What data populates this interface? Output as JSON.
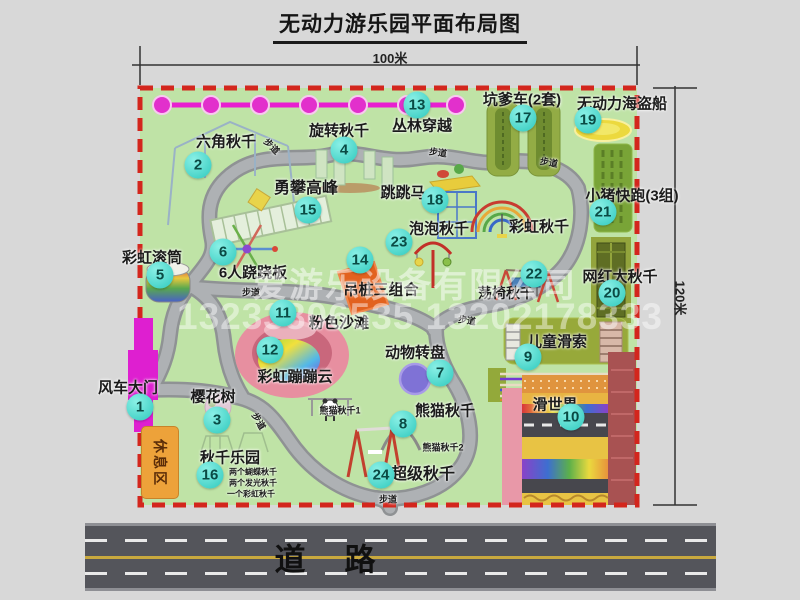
{
  "title": "无动力游乐园平面布局图",
  "dimensions": {
    "top": "100米",
    "right": "120米"
  },
  "road": {
    "label": "道　路"
  },
  "watermark": {
    "company": "爱游乐设备有限公司",
    "phone": "13233806535 13202178333"
  },
  "rest_area_label": "休息区",
  "colors": {
    "park_green": "#bfe3a6",
    "border_red": "#d3261d",
    "marker_cyan": "#2fc9bd",
    "gate_magenta": "#de1fd0",
    "road_gray": "#54555b",
    "path_gray": "#aeb1b4"
  },
  "markers": [
    {
      "n": "1",
      "x": 140,
      "y": 407
    },
    {
      "n": "2",
      "x": 198,
      "y": 165
    },
    {
      "n": "3",
      "x": 217,
      "y": 420
    },
    {
      "n": "4",
      "x": 344,
      "y": 150
    },
    {
      "n": "5",
      "x": 160,
      "y": 275
    },
    {
      "n": "6",
      "x": 223,
      "y": 252
    },
    {
      "n": "7",
      "x": 440,
      "y": 373
    },
    {
      "n": "8",
      "x": 403,
      "y": 424
    },
    {
      "n": "9",
      "x": 528,
      "y": 357
    },
    {
      "n": "10",
      "x": 571,
      "y": 417
    },
    {
      "n": "11",
      "x": 283,
      "y": 313
    },
    {
      "n": "12",
      "x": 270,
      "y": 350
    },
    {
      "n": "13",
      "x": 417,
      "y": 105
    },
    {
      "n": "14",
      "x": 360,
      "y": 260
    },
    {
      "n": "15",
      "x": 308,
      "y": 210
    },
    {
      "n": "16",
      "x": 210,
      "y": 475
    },
    {
      "n": "17",
      "x": 523,
      "y": 118
    },
    {
      "n": "18",
      "x": 435,
      "y": 200
    },
    {
      "n": "19",
      "x": 588,
      "y": 120
    },
    {
      "n": "20",
      "x": 612,
      "y": 293
    },
    {
      "n": "21",
      "x": 603,
      "y": 212
    },
    {
      "n": "22",
      "x": 534,
      "y": 274
    },
    {
      "n": "23",
      "x": 399,
      "y": 242
    },
    {
      "n": "24",
      "x": 381,
      "y": 475
    }
  ],
  "labels": [
    {
      "t": "六角秋千",
      "x": 226,
      "y": 141,
      "s": 15
    },
    {
      "t": "旋转秋千",
      "x": 339,
      "y": 130,
      "s": 15
    },
    {
      "t": "丛林穿越",
      "x": 422,
      "y": 125,
      "s": 15
    },
    {
      "t": "坑爹车(2套)",
      "x": 522,
      "y": 99,
      "s": 15
    },
    {
      "t": "无动力海盗船",
      "x": 622,
      "y": 103,
      "s": 15
    },
    {
      "t": "小猪快跑(3组)",
      "x": 632,
      "y": 195,
      "s": 15
    },
    {
      "t": "勇攀高峰",
      "x": 306,
      "y": 186,
      "s": 16
    },
    {
      "t": "跳跳马",
      "x": 403,
      "y": 192,
      "s": 15
    },
    {
      "t": "泡泡秋千",
      "x": 439,
      "y": 228,
      "s": 15
    },
    {
      "t": "彩虹秋千",
      "x": 539,
      "y": 226,
      "s": 15
    },
    {
      "t": "网红大秋千",
      "x": 620,
      "y": 276,
      "s": 15
    },
    {
      "t": "彩虹滚筒",
      "x": 152,
      "y": 257,
      "s": 15
    },
    {
      "t": "6人跷跷板",
      "x": 253,
      "y": 272,
      "s": 15
    },
    {
      "t": "吊桩三组合",
      "x": 381,
      "y": 289,
      "s": 15
    },
    {
      "t": "荡椅秋千",
      "x": 506,
      "y": 293,
      "s": 14
    },
    {
      "t": "粉色沙滩",
      "x": 339,
      "y": 322,
      "s": 15
    },
    {
      "t": "儿童滑索",
      "x": 557,
      "y": 341,
      "s": 15
    },
    {
      "t": "滑世界",
      "x": 555,
      "y": 404,
      "s": 15
    },
    {
      "t": "风车大门",
      "x": 128,
      "y": 387,
      "s": 15
    },
    {
      "t": "樱花树",
      "x": 213,
      "y": 396,
      "s": 15
    },
    {
      "t": "彩虹蹦蹦云",
      "x": 295,
      "y": 376,
      "s": 15
    },
    {
      "t": "动物转盘",
      "x": 415,
      "y": 352,
      "s": 15
    },
    {
      "t": "熊猫秋千",
      "x": 445,
      "y": 410,
      "s": 15
    },
    {
      "t": "熊猫秋千1",
      "x": 340,
      "y": 410,
      "s": 9
    },
    {
      "t": "熊猫秋千2",
      "x": 443,
      "y": 447,
      "s": 9
    },
    {
      "t": "超级秋千",
      "x": 423,
      "y": 472,
      "s": 16
    },
    {
      "t": "秋千乐园",
      "x": 230,
      "y": 457,
      "s": 15
    },
    {
      "t": "两个蝴蝶秋千",
      "x": 253,
      "y": 472,
      "s": 8
    },
    {
      "t": "两个发光秋千",
      "x": 253,
      "y": 483,
      "s": 8
    },
    {
      "t": "一个彩虹秋千",
      "x": 251,
      "y": 494,
      "s": 8
    },
    {
      "t": "步道",
      "x": 272,
      "y": 146,
      "s": 9,
      "r": 45
    },
    {
      "t": "步道",
      "x": 438,
      "y": 152,
      "s": 9,
      "r": 8
    },
    {
      "t": "步道",
      "x": 549,
      "y": 162,
      "s": 9,
      "r": 10
    },
    {
      "t": "步道",
      "x": 251,
      "y": 292,
      "s": 9,
      "r": 0
    },
    {
      "t": "步道",
      "x": 259,
      "y": 421,
      "s": 9,
      "r": 60
    },
    {
      "t": "步道",
      "x": 467,
      "y": 320,
      "s": 9,
      "r": 8
    },
    {
      "t": "步道",
      "x": 388,
      "y": 499,
      "s": 9,
      "r": 0
    }
  ]
}
